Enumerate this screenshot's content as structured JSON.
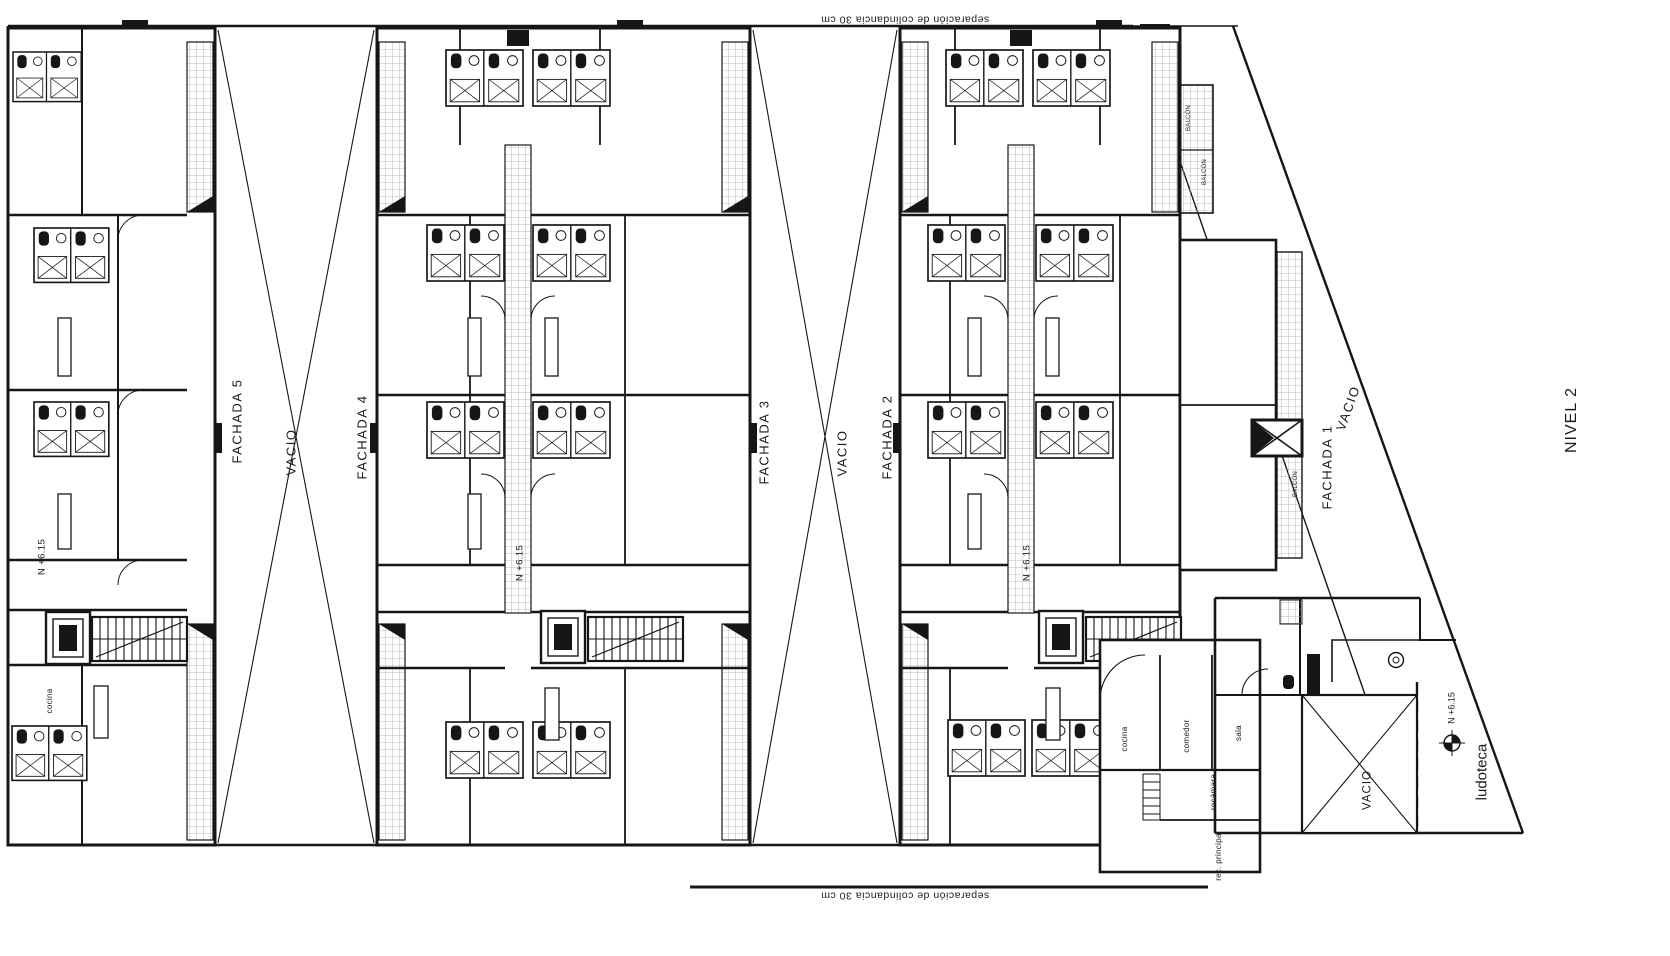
{
  "drawing": {
    "level_title": "NIVEL 2",
    "boundary": {
      "top_label": "separación de colindancia 30 cm",
      "bottom_label": "separación de colindancia 30 cm"
    },
    "facades": {
      "f5": "FACHADA 5",
      "f4": "FACHADA 4",
      "f3": "FACHADA 3",
      "f2": "FACHADA 2",
      "f1": "FACHADA 1"
    },
    "voids": {
      "court_1": "VACIO",
      "court_2": "VACIO",
      "strip": "VACIO",
      "annex": "VACIO"
    },
    "levels": {
      "building_a": "N +6.15",
      "building_b": "N +6.15",
      "building_c": "N +6.15",
      "ludoteca": "N +6.15"
    },
    "rooms": {
      "ludoteca": "ludoteca",
      "cocina_left": "cocina",
      "cocina_right": "cocina",
      "comedor": "comedor",
      "sala": "sala",
      "recamara": "recámara",
      "rec_principal": "rec. principal",
      "balcon_top_1": "BALCÓN",
      "balcon_top_2": "BALCÓN",
      "balcon_mid": "BALCÓN"
    },
    "colors": {
      "line": "#161616",
      "hatch": "#a8a8a8",
      "background": "#ffffff"
    }
  }
}
